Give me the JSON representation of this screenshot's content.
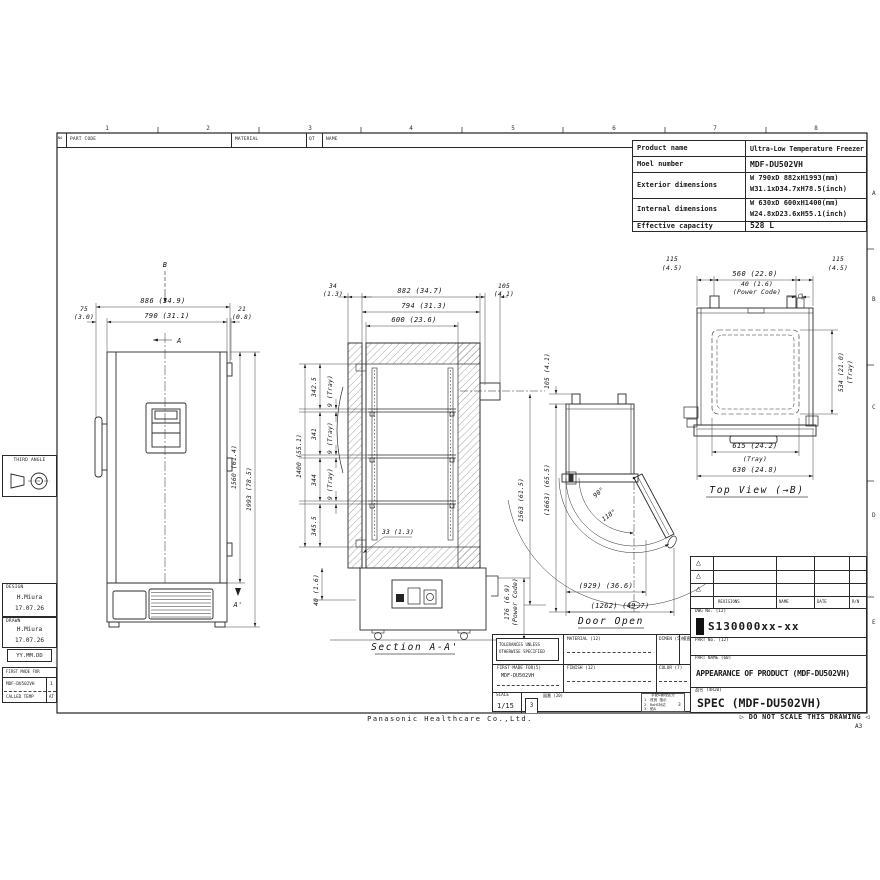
{
  "sheet": {
    "zone_numbers": [
      "1",
      "2",
      "3",
      "4",
      "5",
      "6",
      "7",
      "8"
    ],
    "zone_letters": [
      "A",
      "B",
      "C",
      "D",
      "E"
    ],
    "company": "Panasonic Healthcare Co.,Ltd.",
    "no_scale": "▷ DO NOT SCALE THIS DRAWING ◁",
    "paper_size": "A3"
  },
  "parts_header": {
    "no": "NO",
    "part_code": "PART CODE",
    "material": "MATERIAL",
    "qt": "QT",
    "name": "NAME"
  },
  "spec_table": {
    "rows": [
      {
        "label": "Product name",
        "value": "Ultra-Low Temperature Freezer",
        "value2": ""
      },
      {
        "label": "Moel number",
        "value": "MDF-DU502VH",
        "value2": ""
      },
      {
        "label": "Exterior dimensions",
        "value": "W 790xD 882xH1993(mm)",
        "value2": "W31.1xD34.7xH78.5(inch)"
      },
      {
        "label": "Internal dimensions",
        "value": "W 630xD 600xH1400(mm)",
        "value2": "W24.8xD23.6xH55.1(inch)"
      },
      {
        "label": "Effective capacity",
        "value": "528 L",
        "value2": ""
      }
    ]
  },
  "left_panel": {
    "third_angle": "THIRD ANGLE",
    "design_label": "DESIGN",
    "design_name": "H.Miura",
    "design_date": "17.07.26",
    "drawn_label": "DRAWN",
    "drawn_name": "H.Miura",
    "drawn_date": "17.07.26",
    "date_format": "YY.MM.DD",
    "first_made_for": "FIRST MADE FOR",
    "model": "MDF-DU502VH",
    "model_qty": "1",
    "called_temp": "CALLED TEMP",
    "called_temp_value": "AT"
  },
  "drawing": {
    "front": {
      "b": "B",
      "a": "A",
      "a_prime": "A'",
      "d886": "886 (34.9)",
      "d75": "75",
      "d75in": "(3.0)",
      "d790": "790 (31.1)",
      "d21": "21",
      "d21in": "(0.8)",
      "d1560": "1560 (61.4)",
      "d1993": "1993 (78.5)"
    },
    "section": {
      "title": "Section A-A'",
      "d34": "34",
      "d34in": "(1.3)",
      "d882": "882 (34.7)",
      "d794": "794 (31.3)",
      "d600": "600 (23.6)",
      "d105": "105",
      "d105in": "(4.1)",
      "seg1": "342.5",
      "seg2": "341",
      "seg3": "344",
      "seg4": "345.5",
      "tray": "9 (Tray)",
      "d1400": "1400 (55.1)",
      "d33": "33 (1.3)",
      "d40": "40 (1.6)",
      "d176": "176 (6.9)",
      "power": "(Power Code)"
    },
    "door": {
      "title": "Door Open",
      "d105": "105 (4.1)",
      "d1663": "(1663) (65.5)",
      "d1563": "1563 (61.5)",
      "a90": "90°",
      "a118": "118°",
      "d929": "(929) (36.6)",
      "d1262": "(1262) (49.7)"
    },
    "top": {
      "title": "Top View (→B)",
      "d115": "115",
      "d115in": "(4.5)",
      "d560": "560 (22.0)",
      "d40": "40 (1.6)",
      "power": "(Power Code)",
      "d534": "534 (21.0)",
      "tray": "(Tray)",
      "d615": "615 (24.2)",
      "d630": "630 (24.8)"
    }
  },
  "bottom_block": {
    "tolerances_1": "TOLERANCES UNLESS",
    "tolerances_2": "OTHERWISE SPECIFIED",
    "material_label": "MATERIAL (12)",
    "dimen_label": "DIMEN (5)",
    "kensa_label": "検査",
    "first_made_for_label": "FIRST MADE FOR(5)",
    "first_made_for_value": "MDF-DU502VH",
    "finish_label": "FINISH (12)",
    "color_label": "COLOR (7)",
    "scale_label": "SCALE",
    "scale_value": "1/15",
    "rev_no": "3",
    "zuban_label": "図番 (20)",
    "mgmt_header": "手配&管理区分",
    "mgmt_rows": [
      {
        "no": "1",
        "text": "改良 指示"
      },
      {
        "no": "2",
        "text": "RoHS対応"
      },
      {
        "no": "3",
        "text": "鉛A"
      }
    ],
    "mgmt_value": "3"
  },
  "title_block": {
    "revision_triangle": "△",
    "revisions_label": "REVISIONS",
    "name_label": "NAME",
    "date_label": "DATE",
    "rn_label": "R/N",
    "dwg_no_label": "DWG No. (12)",
    "dwg_no": "S130000xx-xx",
    "part_no_label": "PART No. (12)",
    "part_name_label": "PART NAME (60)",
    "part_name": "APPEARANCE OF PRODUCT (MDF-DU502VH)",
    "hinmei_label": "品名 (4R20)",
    "spec": "SPEC (MDF-DU502VH)"
  }
}
